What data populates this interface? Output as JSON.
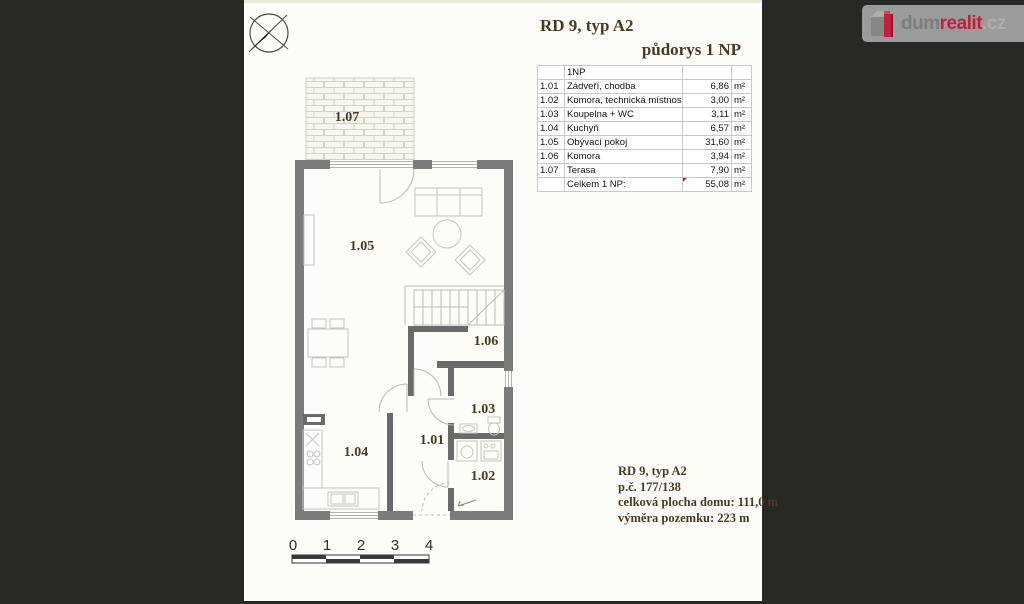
{
  "titles": {
    "main": "RD 9, typ A2",
    "sub": "půdorys 1 NP"
  },
  "table": {
    "header": "1NP",
    "rows": [
      {
        "num": "1.01",
        "name": "Zádveří, chodba",
        "value": "6,86",
        "unit": "m²"
      },
      {
        "num": "1.02",
        "name": "Komora, technická místnost",
        "value": "3,00",
        "unit": "m²"
      },
      {
        "num": "1.03",
        "name": "Koupelna + WC",
        "value": "3,11",
        "unit": "m²"
      },
      {
        "num": "1.04",
        "name": "Kuchyň",
        "value": "6,57",
        "unit": "m²"
      },
      {
        "num": "1.05",
        "name": "Obývací pokoj",
        "value": "31,60",
        "unit": "m²"
      },
      {
        "num": "1.06",
        "name": "Komora",
        "value": "3,94",
        "unit": "m²"
      },
      {
        "num": "1.07",
        "name": "Terasa",
        "value": "7,90",
        "unit": "m²"
      }
    ],
    "total": {
      "label": "Celkem 1 NP:",
      "value": "55,08",
      "unit": "m²"
    }
  },
  "plan": {
    "labels": {
      "r101": "1.01",
      "r102": "1.02",
      "r103": "1.03",
      "r104": "1.04",
      "r105": "1.05",
      "r106": "1.06",
      "r107": "1.07"
    },
    "scale": {
      "ticks": [
        "0",
        "1",
        "2",
        "3",
        "4"
      ]
    }
  },
  "info": {
    "lines": [
      "RD 9, typ A2",
      "p.č. 177/138",
      "celková plocha domu: 111,0 m",
      "výměra pozemku: 223 m"
    ]
  },
  "logo": {
    "dum": "dum",
    "realit": "realit",
    "cz": ".cz"
  },
  "colors": {
    "accent_red": "#c51f3f",
    "wall_gray": "#7b7b7b",
    "label_brown": "#4a3a22"
  }
}
